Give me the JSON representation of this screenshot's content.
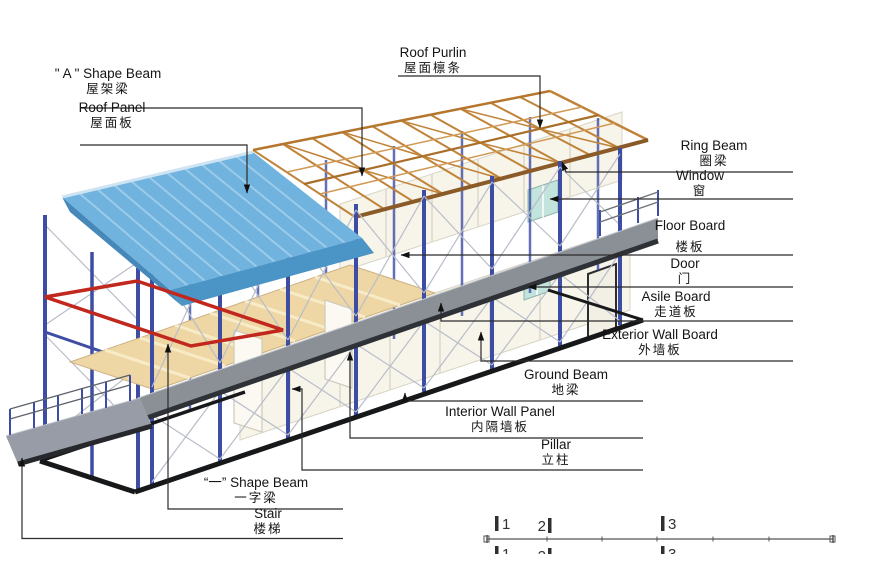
{
  "labels": {
    "roof_purlin": {
      "en": "Roof Purlin",
      "zh": "屋面檩条"
    },
    "a_shape_beam": {
      "en": "\" A \" Shape Beam",
      "zh": "屋架梁"
    },
    "roof_panel": {
      "en": "Roof Panel",
      "zh": "屋面板"
    },
    "ring_beam": {
      "en": "Ring Beam",
      "zh": "圈梁"
    },
    "window": {
      "en": "Window",
      "zh": "窗"
    },
    "floor_board": {
      "en": "Floor Board",
      "zh": "楼板"
    },
    "door": {
      "en": "Door",
      "zh": "门"
    },
    "asile_board": {
      "en": "Asile Board",
      "zh": "走道板"
    },
    "exterior_wall_board": {
      "en": "Exterior Wall Board",
      "zh": "外墙板"
    },
    "ground_beam": {
      "en": "Ground Beam",
      "zh": "地梁"
    },
    "interior_wall_panel": {
      "en": "Interior Wall Panel",
      "zh": "内隔墙板"
    },
    "pillar": {
      "en": "Pillar",
      "zh": "立柱"
    },
    "one_shape_beam": {
      "en": "“一” Shape Beam",
      "zh": "一字梁"
    },
    "stair": {
      "en": "Stair",
      "zh": "楼梯"
    }
  },
  "ruler": {
    "row1": [
      "1",
      "2",
      "3"
    ],
    "row2": [
      "1",
      "2",
      "3"
    ]
  },
  "colors": {
    "roof_blue": "#6fb3de",
    "roof_rib": "#9dcbe9",
    "roof_fascia": "#4b94c6",
    "roof_fascia_side": "#4788ba",
    "truss_orange": "#c08338",
    "ring_beam_brown": "#8a5a28",
    "pillar_blue": "#3d4da4",
    "brace_gray": "#b8bdc9",
    "wall_cream": "#f7f4ea",
    "wood_tan": "#eed7a4",
    "walk_gray": "#8b9097",
    "ground_black": "#17181a",
    "beam_red": "#c1271d",
    "window_teal": "#c3e4dc"
  }
}
